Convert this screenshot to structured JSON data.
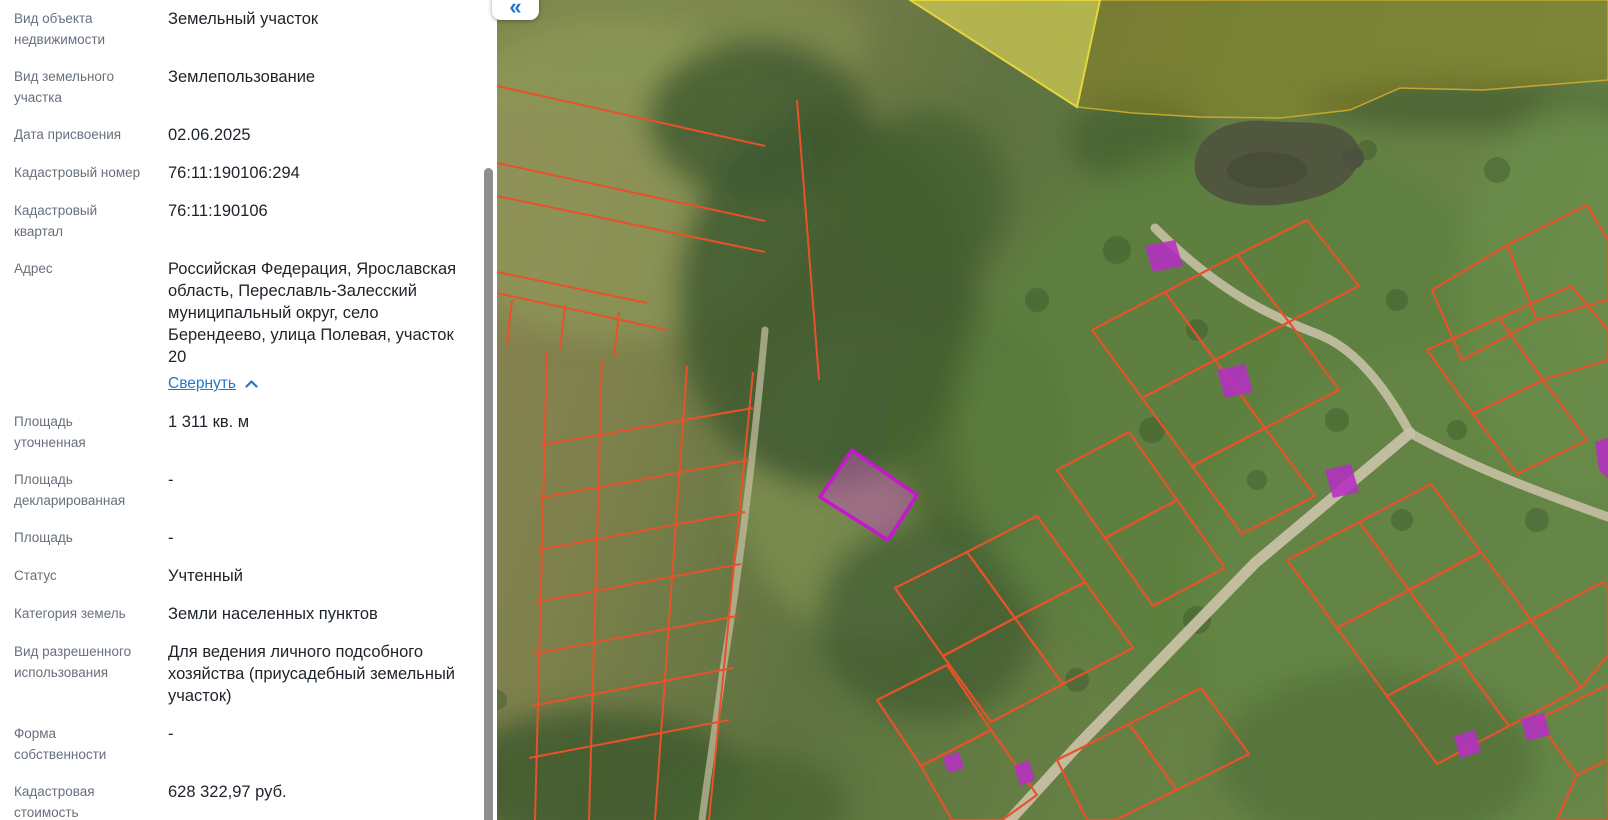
{
  "panel": {
    "rows": [
      {
        "label": "Вид объекта недвижимости",
        "value": "Земельный участок"
      },
      {
        "label": "Вид земельного участка",
        "value": "Землепользование"
      },
      {
        "label": "Дата присвоения",
        "value": "02.06.2025"
      },
      {
        "label": "Кадастровый номер",
        "value": "76:11:190106:294"
      },
      {
        "label": "Кадастровый квартал",
        "value": "76:11:190106"
      },
      {
        "label": "Адрес",
        "value": "Российская Федерация, Ярославская область, Переславль-Залесский муниципальный округ, село Берендеево, улица Полевая, участок 20"
      },
      {
        "label": "Площадь уточненная",
        "value": "1 311 кв. м"
      },
      {
        "label": "Площадь декларированная",
        "value": "-"
      },
      {
        "label": "Площадь",
        "value": "-"
      },
      {
        "label": "Статус",
        "value": "Учтенный"
      },
      {
        "label": "Категория земель",
        "value": "Земли населенных пунктов"
      },
      {
        "label": "Вид разрешенного использования",
        "value": "Для ведения личного подсобного хозяйства (приусадебный земельный участок)"
      },
      {
        "label": "Форма собственности",
        "value": "-"
      },
      {
        "label": "Кадастровая стоимость",
        "value": "628 322,97 руб."
      }
    ],
    "address_link": "Свернуть"
  },
  "map": {
    "collapse_button": "«",
    "colors": {
      "parcel_line": "#e8522a",
      "selected_parcel_stroke": "#c617cf",
      "selected_parcel_fill": "rgba(207,82,201,0.45)",
      "building_fill": "#b62fc4",
      "zone_bright_fill": "rgba(233,221,88,0.60)",
      "zone_bright_stroke": "#e5d53e",
      "zone_olive_fill": "rgba(158,138,30,0.38)",
      "zone_olive_stroke": "#c8a62e",
      "road": "#c7c0a4",
      "water": "#51563f",
      "link_blue": "#2176d2"
    }
  }
}
